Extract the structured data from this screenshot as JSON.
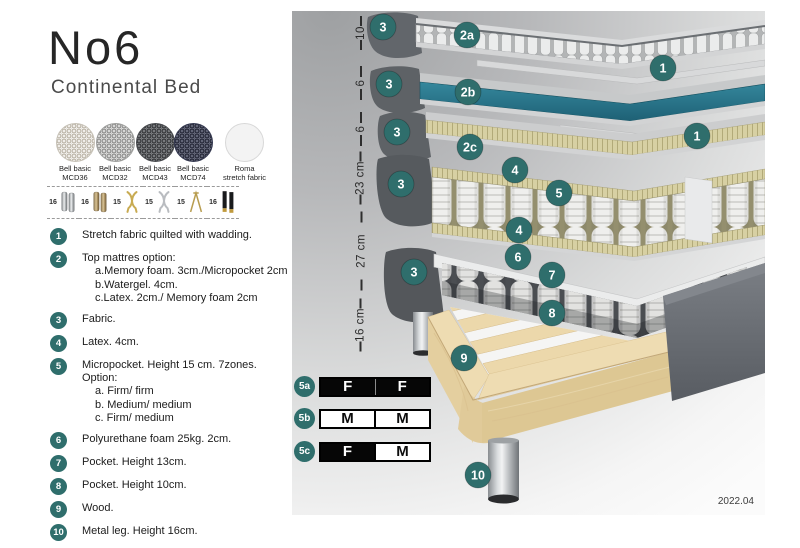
{
  "header": {
    "title": "No6",
    "subtitle": "Continental Bed"
  },
  "fabrics": [
    {
      "name": "Bell basic",
      "code": "MCD36"
    },
    {
      "name": "Bell basic",
      "code": "MCD32"
    },
    {
      "name": "Bell basic",
      "code": "MCD43"
    },
    {
      "name": "Bell basic",
      "code": "MCD74"
    },
    {
      "name": "Roma",
      "code": "stretch fabric"
    }
  ],
  "leg_options": [
    {
      "height": "16",
      "type": "metal cylinder"
    },
    {
      "height": "16",
      "type": "wood cylinder"
    },
    {
      "height": "15",
      "type": "gold twisted"
    },
    {
      "height": "15",
      "type": "silver twisted"
    },
    {
      "height": "15",
      "type": "hairpin"
    },
    {
      "height": "16",
      "type": "black tapered"
    }
  ],
  "legend": [
    {
      "num": "1",
      "text": "Stretch fabric quilted with wadding."
    },
    {
      "num": "2",
      "text": "Top mattres option:",
      "subs": [
        "a.Memory foam. 3cm./Micropocket 2cm",
        "b.Watergel. 4cm.",
        "c.Latex. 2cm./ Memory foam 2cm"
      ]
    },
    {
      "num": "3",
      "text": "Fabric."
    },
    {
      "num": "4",
      "text": "Latex. 4cm."
    },
    {
      "num": "5",
      "text": "Micropocket. Height 15 cm. 7zones. Option:",
      "subs": [
        "a. Firm/ firm",
        "b. Medium/ medium",
        "c. Firm/ medium"
      ]
    },
    {
      "num": "6",
      "text": "Polyurethane foam 25kg. 2cm."
    },
    {
      "num": "7",
      "text": "Pocket. Height 13cm."
    },
    {
      "num": "8",
      "text": "Pocket. Height 10cm."
    },
    {
      "num": "9",
      "text": "Wood."
    },
    {
      "num": "10",
      "text": "Metal leg. Height 16cm."
    }
  ],
  "diagram": {
    "ruler": [
      {
        "label": "10"
      },
      {
        "label": "6"
      },
      {
        "label": "6"
      },
      {
        "label": "23 cm"
      },
      {
        "label": "27 cm"
      },
      {
        "label": "16 cm"
      }
    ],
    "callouts": [
      {
        "label": "3"
      },
      {
        "label": "2a"
      },
      {
        "label": "1"
      },
      {
        "label": "3"
      },
      {
        "label": "2b"
      },
      {
        "label": "3"
      },
      {
        "label": "2c"
      },
      {
        "label": "1"
      },
      {
        "label": "4"
      },
      {
        "label": "3"
      },
      {
        "label": "5"
      },
      {
        "label": "4"
      },
      {
        "label": "6"
      },
      {
        "label": "3"
      },
      {
        "label": "7"
      },
      {
        "label": "8"
      },
      {
        "label": "9"
      },
      {
        "label": "10"
      }
    ],
    "firmness": [
      {
        "id": "5a",
        "cells": [
          {
            "letter": "F",
            "fill": "dark"
          },
          {
            "letter": "F",
            "fill": "dark"
          }
        ]
      },
      {
        "id": "5b",
        "cells": [
          {
            "letter": "M",
            "fill": "light"
          },
          {
            "letter": "M",
            "fill": "light"
          }
        ]
      },
      {
        "id": "5c",
        "cells": [
          {
            "letter": "F",
            "fill": "dark"
          },
          {
            "letter": "M",
            "fill": "light"
          }
        ]
      }
    ],
    "version": "2022.04"
  },
  "colors": {
    "accent_teal": "#2f6e6c",
    "watergel_teal": "#2a7a8e",
    "foam_khaki": "#d6cfa2",
    "wood": "#ecd9ae"
  }
}
